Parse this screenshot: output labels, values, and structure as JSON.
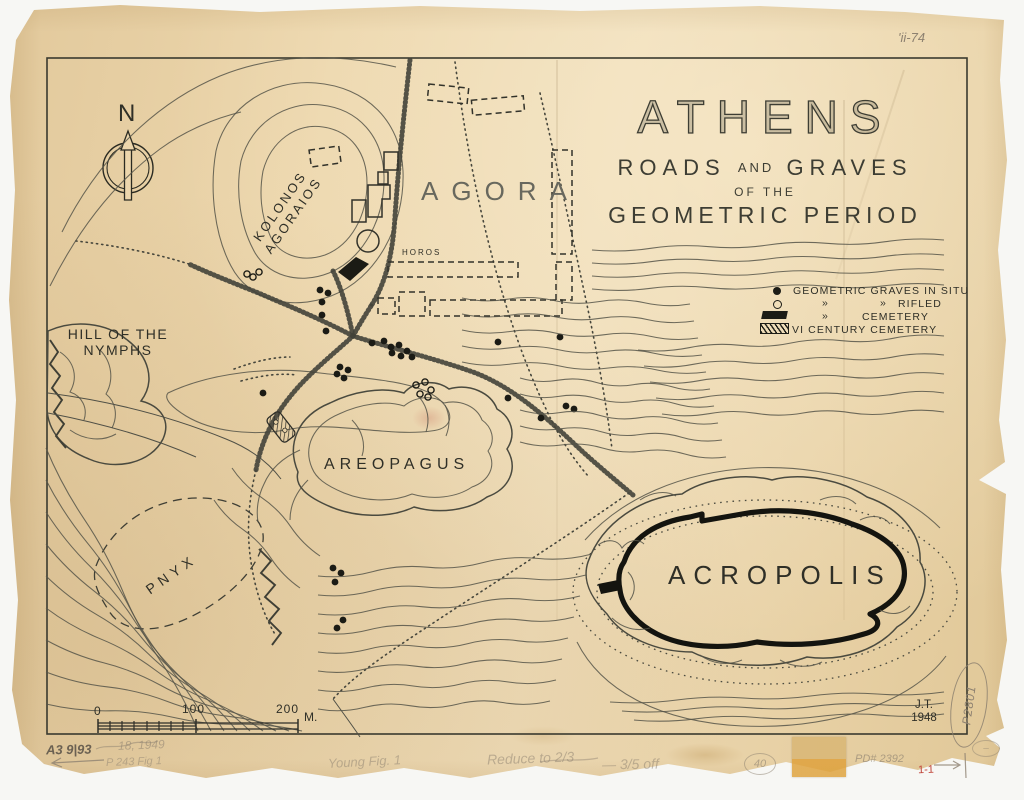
{
  "accents": {
    "ink": "#3a3a2f",
    "paper": "#e9d2a7",
    "pencil": "#8d8170",
    "red": "#c0453a"
  },
  "compass": {
    "label": "N"
  },
  "title": {
    "main": "ATHENS",
    "sub1_w1": "ROADS",
    "sub1_w2": "AND",
    "sub1_w3": "GRAVES",
    "sub2": "OF THE",
    "sub3": "GEOMETRIC PERIOD"
  },
  "legend": {
    "row1_label": "GEOMETRIC GRAVES IN SITU",
    "row2_d1": "»",
    "row2_d2": "»",
    "row2_label": "RIFLED",
    "row3_d1": "»",
    "row3_label": "CEMETERY",
    "row4_label": "VI CENTURY CEMETERY"
  },
  "map_labels": {
    "kolonos_line1": "KOLONOS",
    "kolonos_line2": "AGORAIOS",
    "agora": "AGORA",
    "horos": "HOROS",
    "hill_line1": "HILL OF THE",
    "hill_line2": "NYMPHS",
    "areopagus": "AREOPAGUS",
    "pnyx": "PNYX",
    "acropolis": "ACROPOLIS"
  },
  "scale": {
    "t0": "0",
    "t1": "100",
    "t2": "200",
    "unit": "M."
  },
  "credit": {
    "initials": "J.T.",
    "year": "1948"
  },
  "annotations": {
    "top_right": "'ii-74",
    "code": "A3 9|93",
    "date_note": "18, 1949",
    "fig_note": "P 243 Fig 1",
    "center_note": "Young Fig. 1",
    "reduce_note": "Reduce to 2/3",
    "reduce_note2": "— 3/5 off",
    "circled_number": "40",
    "pd_number": "PD# 2392",
    "red_mark": "1-1",
    "side_number": "P2801",
    "circled_dash": "–"
  },
  "map_points": {
    "graves_in_situ": [
      [
        320,
        290
      ],
      [
        328,
        293
      ],
      [
        322,
        302
      ],
      [
        322,
        315
      ],
      [
        326,
        331
      ],
      [
        263,
        393
      ],
      [
        340,
        367
      ],
      [
        348,
        370
      ],
      [
        337,
        374
      ],
      [
        344,
        378
      ],
      [
        372,
        343
      ],
      [
        384,
        341
      ],
      [
        391,
        347
      ],
      [
        399,
        345
      ],
      [
        407,
        351
      ],
      [
        401,
        356
      ],
      [
        392,
        353
      ],
      [
        412,
        357
      ],
      [
        498,
        342
      ],
      [
        560,
        337
      ],
      [
        508,
        398
      ],
      [
        541,
        418
      ],
      [
        566,
        406
      ],
      [
        574,
        409
      ],
      [
        333,
        568
      ],
      [
        341,
        573
      ],
      [
        335,
        582
      ],
      [
        343,
        620
      ],
      [
        337,
        628
      ]
    ],
    "graves_rifled": [
      [
        247,
        274
      ],
      [
        253,
        277
      ],
      [
        259,
        272
      ],
      [
        416,
        385
      ],
      [
        425,
        382
      ],
      [
        431,
        390
      ],
      [
        420,
        394
      ],
      [
        428,
        397
      ]
    ]
  }
}
